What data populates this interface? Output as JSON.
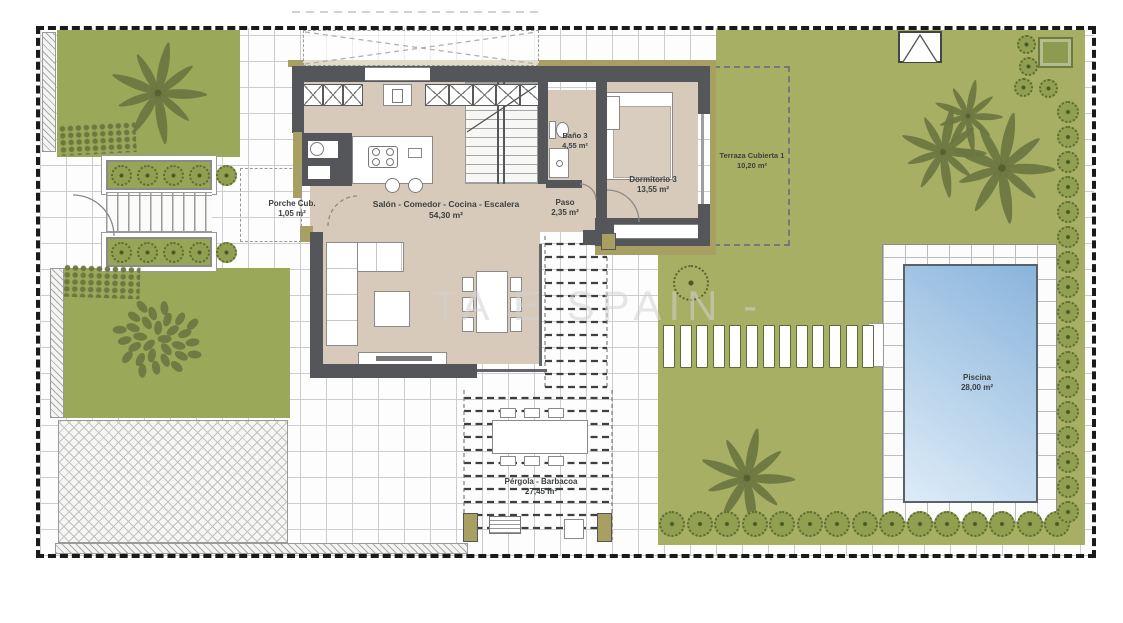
{
  "watermark": "TA E SPAIN -",
  "rooms": {
    "porche": {
      "name": "Porche Cub.",
      "area": "1,05 m²"
    },
    "salon": {
      "name": "Salón - Comedor - Cocina - Escalera",
      "area": "54,30 m²"
    },
    "paso": {
      "name": "Paso",
      "area": "2,35 m²"
    },
    "bano3": {
      "name": "Baño 3",
      "area": "4,55 m²"
    },
    "dormitorio3": {
      "name": "Dormitorio 3",
      "area": "13,55 m²"
    },
    "terraza": {
      "name": "Terraza Cubierta 1",
      "area": "10,20 m²"
    },
    "pergola": {
      "name": "Pérgola - Barbacoa",
      "area": "27,45 m²"
    },
    "piscina": {
      "name": "Piscina",
      "area": "28,00 m²"
    }
  },
  "colors": {
    "garden": "#a6af63",
    "garden-dark": "#9aa85a",
    "foliage": "#6b7540",
    "wall": "#54565a",
    "wall-accent": "#a89f63",
    "floor": "#d7cabb",
    "water-deep": "#8ab4dc",
    "water-light": "#ddecf7",
    "label": "#3d4040",
    "boundary": "#1a1a1a"
  }
}
